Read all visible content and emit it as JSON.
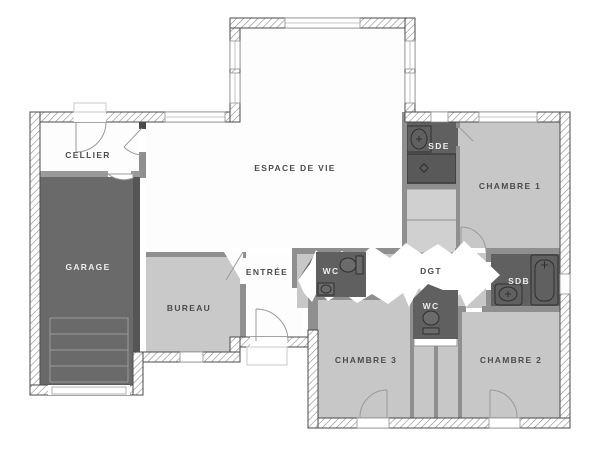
{
  "plan": {
    "type": "architectural-floor-plan",
    "rooms": {
      "cellier": {
        "label": "CELLIER"
      },
      "garage": {
        "label": "GARAGE"
      },
      "espace_de_vie": {
        "label": "ESPACE DE VIE"
      },
      "entree": {
        "label": "ENTRÉE"
      },
      "bureau": {
        "label": "BUREAU"
      },
      "sde": {
        "label": "SDE"
      },
      "chambre1": {
        "label": "CHAMBRE 1"
      },
      "wc1": {
        "label": "WC"
      },
      "dgt": {
        "label": "DGT"
      },
      "sdb": {
        "label": "SDB"
      },
      "wc2": {
        "label": "WC"
      },
      "chambre3": {
        "label": "CHAMBRE 3"
      },
      "chambre2": {
        "label": "CHAMBRE 2"
      }
    },
    "fixtures": {
      "sde": [
        "washbasin-icon",
        "shower-icon"
      ],
      "wc1": [
        "toilet-icon",
        "handbasin-icon"
      ],
      "wc2": [
        "toilet-icon"
      ],
      "sdb": [
        "washbasin-icon",
        "bathtub-icon"
      ]
    },
    "colors": {
      "background": "#ffffff",
      "floor_white": "#fdfdfd",
      "floor_light": "#c7c7c7",
      "floor_closet": "#d0d0d0",
      "floor_dark": "#606060",
      "garage_dark": "#6a6a6a",
      "wall_interior": "#8f8f8f",
      "wall_dark": "#4f4f4f",
      "wall_outline": "#4a4a4a",
      "highlight_band": "#ffffff",
      "label_dark": "#4c4c4c",
      "label_light": "#ededed"
    }
  }
}
